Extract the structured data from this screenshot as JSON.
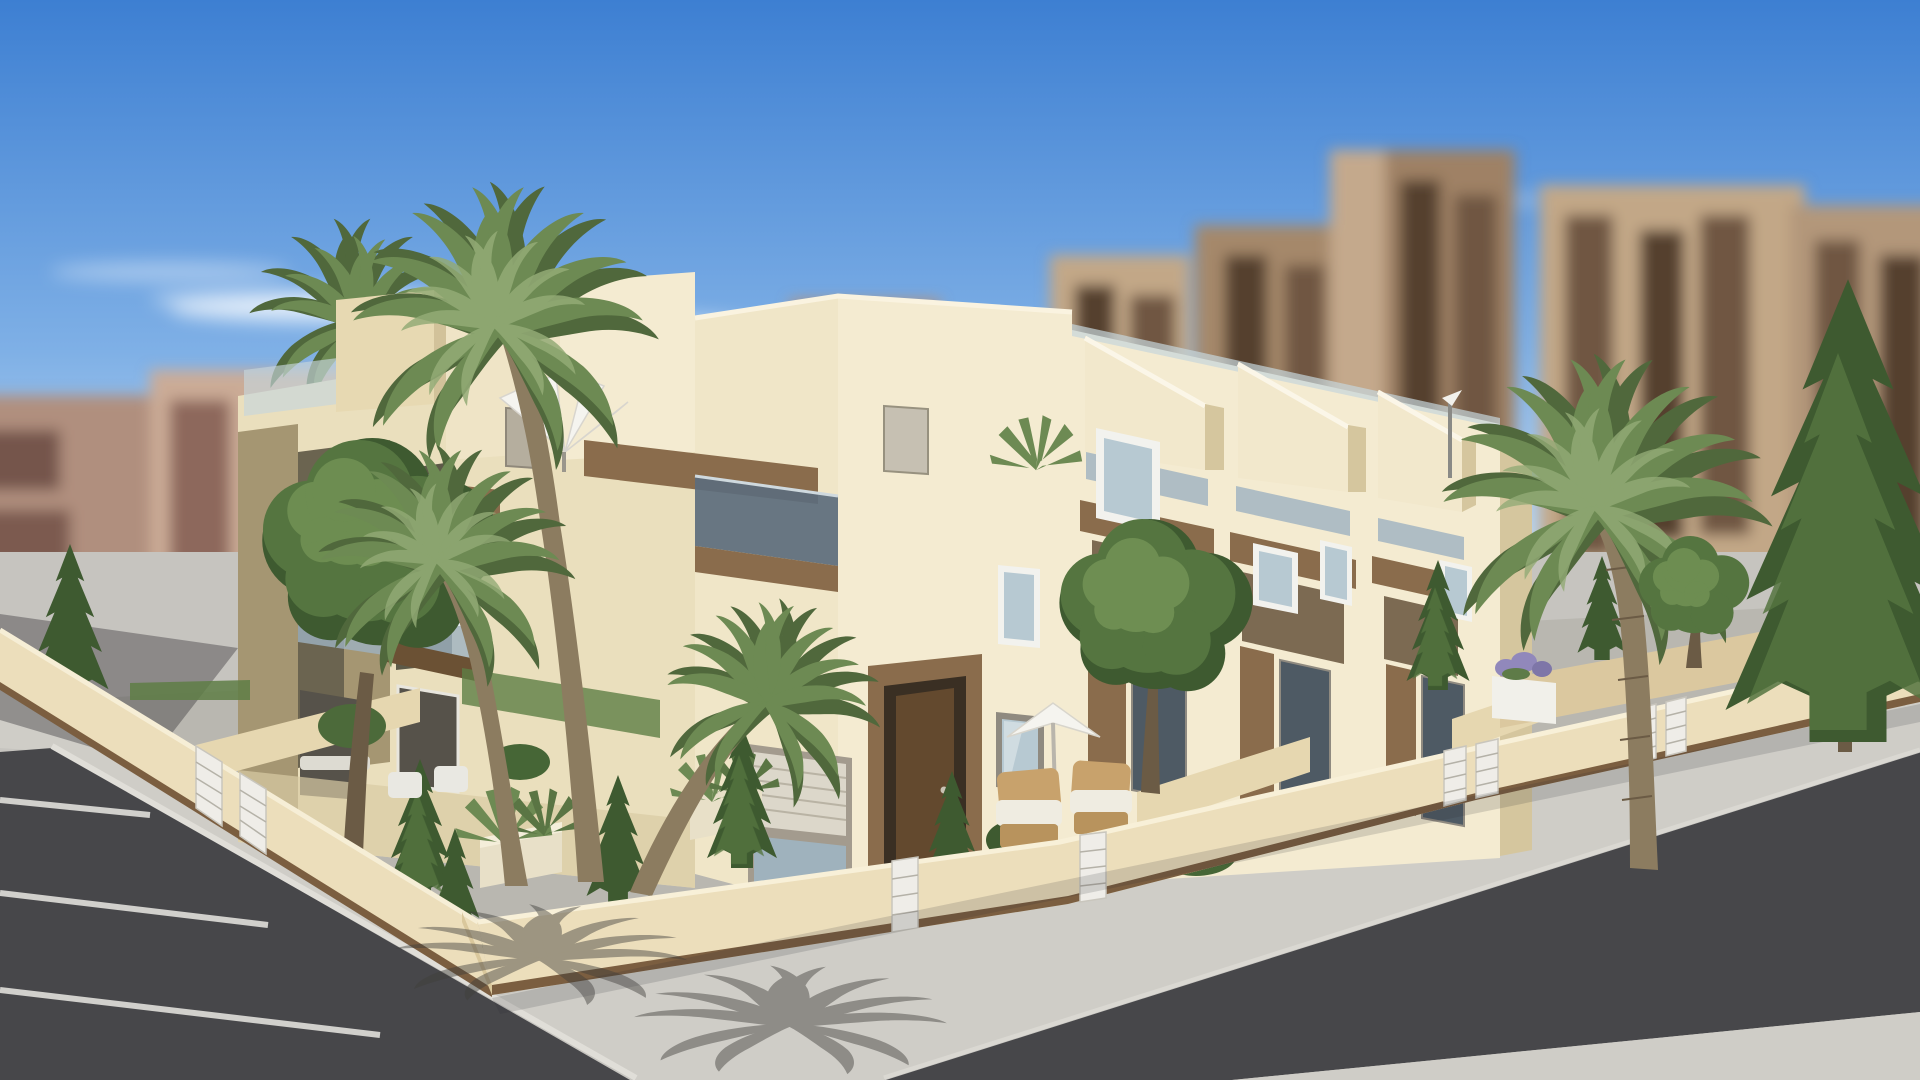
{
  "image": {
    "type": "3d-architectural-render",
    "subject": "Modern cream-coloured Mediterranean townhouse complex on a street corner",
    "environment": "Sunny day, blue sky, blurred high-rise apartment blocks behind",
    "camera": "Elevated two-point-perspective corner view"
  },
  "scene": {
    "sky": {
      "clouds": 5
    },
    "background": {
      "left_blocks": "blurred pink-tan apartments",
      "right_blocks": "blurred tall brown towers"
    },
    "complex": {
      "floors": 3,
      "features": [
        "roof terraces",
        "glass balustrades",
        "wood-clad balcony boxes",
        "roller shutters",
        "recessed wood entry portals",
        "white parasols",
        "stepped roof volumes"
      ]
    },
    "vegetation": {
      "palm_trees": 5,
      "conifers": 8,
      "round_trees": 3,
      "agave_planters": 3
    },
    "street": {
      "parking_bays": 3,
      "roads": 2,
      "white_gate_panels": 9
    },
    "furniture": {
      "patio_parasol": 1,
      "roof_parasol": 1,
      "wicker_chairs": 2,
      "white_chairs": 2
    }
  },
  "colors": {
    "sky_top": "#3d7fd2",
    "sky_mid": "#7fb0e6",
    "sky_horizon": "#d9e9f6",
    "cloud": "#ffffff",
    "bgL_light": "#cbab96",
    "bgL_mid": "#b08f7e",
    "bgL_dark": "#8d685c",
    "bgL_win": "#74544b",
    "bgR_light": "#c2a787",
    "bgR_mid": "#a5886b",
    "bgR_dark": "#7c604c",
    "bgR_win": "#54402f",
    "facade_light": "#f4ebd1",
    "facade_mid": "#eadfbd",
    "facade_dark": "#d5c69e",
    "facade_olive": "#a59672",
    "recess": "#6b6450",
    "wood": "#8a6c4c",
    "wood_dark": "#6b5134",
    "glass": "#9db2c0",
    "glass_dark": "#5c6d7c",
    "glass_light": "#c6d5dc",
    "frame_white": "#f2f2ee",
    "win_glass": "#b7c9d2",
    "shutter": "#dcd7ca",
    "door": "#63492e",
    "fence": "#ecdebb",
    "fence_dark": "#dbc89f",
    "fence_base": "#7b5e40",
    "slat": "#efede8",
    "road": "#47474a",
    "road_line": "#e0dfdb",
    "sidewalk": "#cfcdc7",
    "pavement": "#c6c4bf",
    "garden_floor": "#b9b7b0",
    "grass": "#5e7e45",
    "tree_dark": "#3e5a30",
    "tree_mid": "#557540",
    "tree_light": "#739356",
    "palm_dark": "#50683c",
    "palm_mid": "#6d8a53",
    "palm_light": "#93ab76",
    "trunk": "#8c7c60",
    "trunk_dark": "#6b5b45",
    "parasol": "#f5f4ef",
    "wicker": "#c8a26c",
    "cushion": "#efece1",
    "flower": "#9188bb",
    "shadow": "#3f3e3b"
  }
}
